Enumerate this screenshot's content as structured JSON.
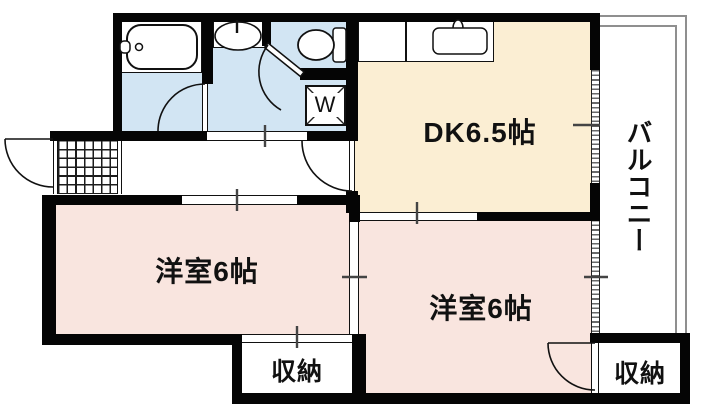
{
  "plan": {
    "type": "japanese-apartment-floorplan",
    "rooms": {
      "dk": {
        "label": "DK6.5帖"
      },
      "west_room_left": {
        "label": "洋室6帖"
      },
      "west_room_right": {
        "label": "洋室6帖"
      },
      "storage_center": {
        "label": "収納"
      },
      "storage_right": {
        "label": "収納"
      },
      "balcony": {
        "label": "バルコニー"
      },
      "washer_space": {
        "label": "W"
      }
    },
    "colors": {
      "wet_area": "#d2e5f3",
      "dining_kitchen": "#fbeed3",
      "western_room": "#f9e5df",
      "wall": "#050505",
      "balcony_rail": "#8f8f8f"
    }
  }
}
